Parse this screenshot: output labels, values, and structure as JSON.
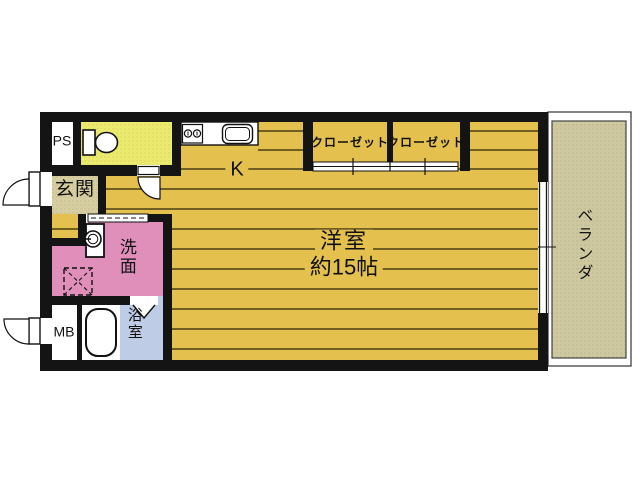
{
  "plan": {
    "rooms": {
      "ps": {
        "label": "PS"
      },
      "entrance": {
        "label": "玄関"
      },
      "washroom": {
        "label": "洗面"
      },
      "meter_box": {
        "label": "MB"
      },
      "bathroom": {
        "label": "浴室"
      },
      "kitchen": {
        "label": "K"
      },
      "closet_1": {
        "label": "クローゼット"
      },
      "closet_2": {
        "label": "クローゼット"
      },
      "main_room": {
        "label": "洋室",
        "size": "約15帖"
      },
      "veranda": {
        "label": "ベランダ"
      }
    },
    "colors": {
      "floor": "#e4c04e",
      "toilet": "#ece96f",
      "entrance": "#d6cda0",
      "washroom": "#e08fbb",
      "bathroom": "#becde5",
      "veranda": "#cdc89f",
      "wall": "#141414",
      "floor_line": "#2b2408"
    }
  }
}
